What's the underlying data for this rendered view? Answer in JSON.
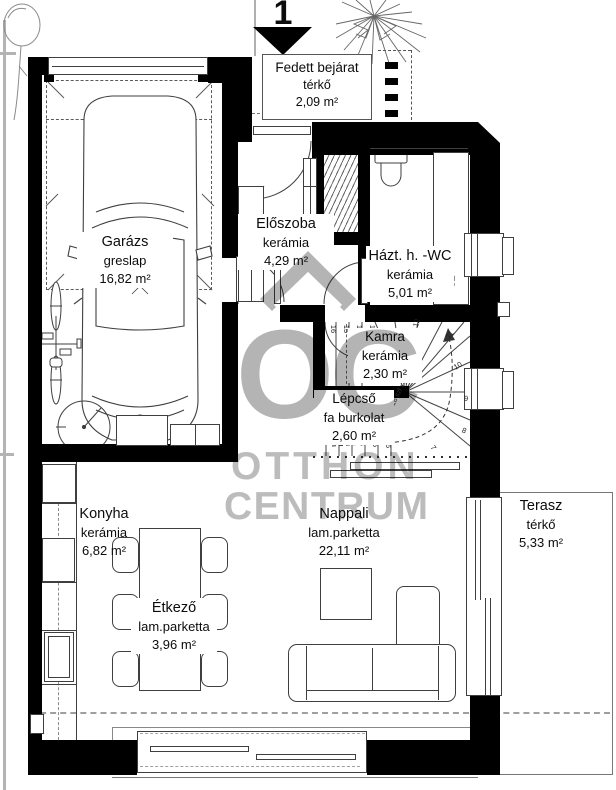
{
  "north": {
    "label": "1"
  },
  "watermark": {
    "monogram": "OC",
    "line1": "OTTHON",
    "line2": "CENTRUM"
  },
  "rooms": [
    {
      "name": "Garázs",
      "floor": "greslap",
      "area": "16,82 m²"
    },
    {
      "name": "Fedett bejárat",
      "floor": "térkő",
      "area": "2,09 m²"
    },
    {
      "name": "Előszoba",
      "floor": "kerámia",
      "area": "4,29 m²"
    },
    {
      "name": "Házt. h. -WC",
      "floor": "kerámia",
      "area": "5,01 m²"
    },
    {
      "name": "Kamra",
      "floor": "kerámia",
      "area": "2,30 m²"
    },
    {
      "name": "Lépcső",
      "floor": "fa burkolat",
      "area": "2,60 m²"
    },
    {
      "name": "Konyha",
      "floor": "kerámia",
      "area": "6,82 m²"
    },
    {
      "name": "Étkező",
      "floor": "lam.parketta",
      "area": "3,96 m²"
    },
    {
      "name": "Nappali",
      "floor": "lam.parketta",
      "area": "22,11 m²"
    },
    {
      "name": "Terasz",
      "floor": "térkő",
      "area": "5,33 m²"
    }
  ],
  "stairs": {
    "numbers": [
      "1",
      "2",
      "3",
      "4",
      "5",
      "6",
      "7",
      "8",
      "9",
      "10",
      "11",
      "12",
      "13",
      "14",
      "15",
      "16"
    ],
    "note": "18 szl x17,06/27,58"
  },
  "annotations": {
    "washer": "SZ"
  },
  "colors": {
    "wall": "#000000",
    "line": "#3f3f3f",
    "watermark": "#b7b7b7",
    "boundary": "#b4b4b4"
  }
}
